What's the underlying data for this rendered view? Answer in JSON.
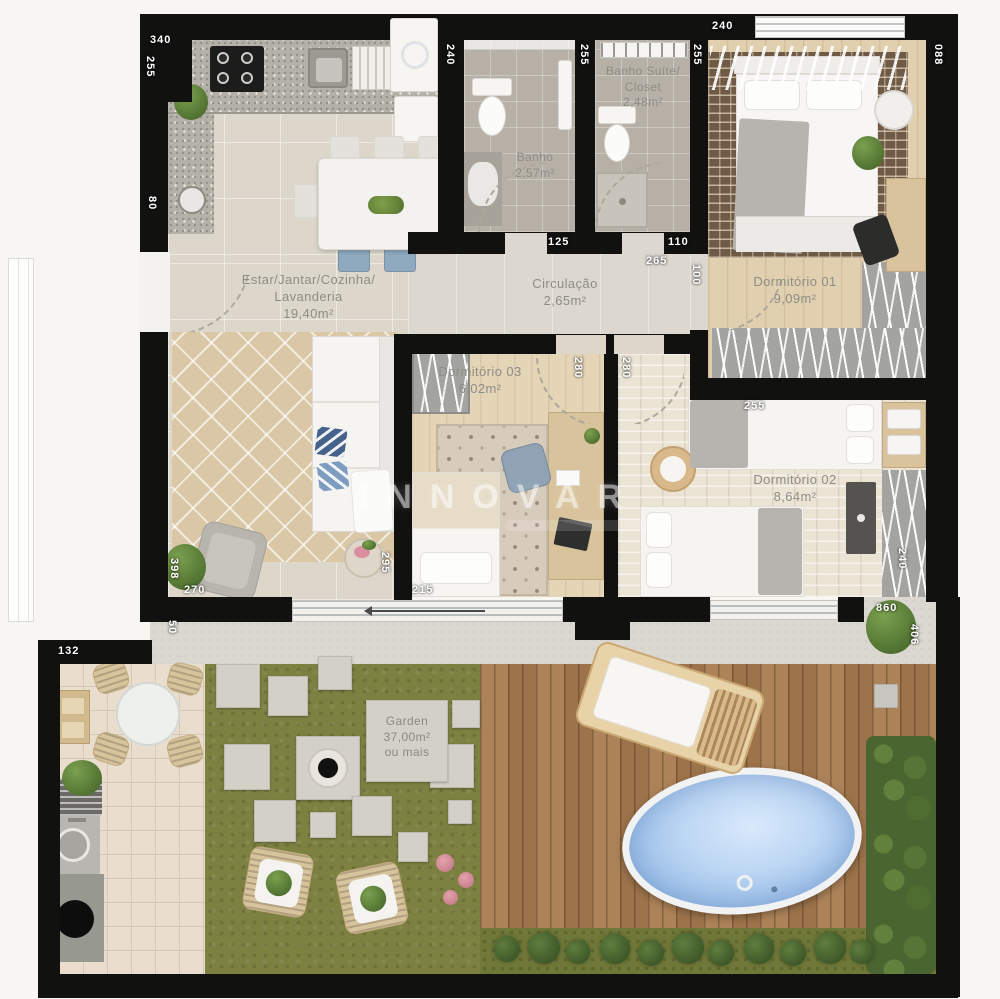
{
  "watermark": {
    "text": "INNOVAR"
  },
  "rooms": {
    "living": {
      "name_line1": "Estar/Jantar/Cozinha/",
      "name_line2": "Lavanderia",
      "area": "19,40m²"
    },
    "circulation": {
      "name": "Circulação",
      "area": "2,65m²"
    },
    "bath": {
      "name": "Banho",
      "area": "2,57m²"
    },
    "bath_suite": {
      "name_line1": "Banho Suíte/",
      "name_line2": "Closet",
      "area": "2,48m²"
    },
    "bedroom_01": {
      "name": "Dormitório 01",
      "area": "9,09m²"
    },
    "bedroom_02": {
      "name": "Dormitório 02",
      "area": "8,64m²"
    },
    "bedroom_03": {
      "name": "Dormitório 03",
      "area": "6,02m²"
    },
    "garden": {
      "name": "Garden",
      "area": "37,00m²",
      "note": "ou mais"
    }
  },
  "dims": {
    "d340": "340",
    "d255a": "255",
    "d80": "80",
    "d240a": "240",
    "d255b": "255",
    "d255c": "255",
    "d240b": "240",
    "d088": "088",
    "d125": "125",
    "d110": "110",
    "d265": "265",
    "d100": "100",
    "d280a": "280",
    "d280b": "280",
    "d255d": "255",
    "d240c": "240",
    "d295": "295",
    "d215": "215",
    "d270": "270",
    "d398": "398",
    "d50": "50",
    "d132": "132",
    "d860": "860",
    "d406": "406"
  },
  "colors": {
    "wall": "#111110",
    "grass": "#7c8041",
    "pool_water": "#abc9ec",
    "deck_wood": "#a87c50",
    "floor_beige": "#ddd7cb",
    "label_gray": "#8d8d87",
    "dim_white": "#ffffff"
  }
}
